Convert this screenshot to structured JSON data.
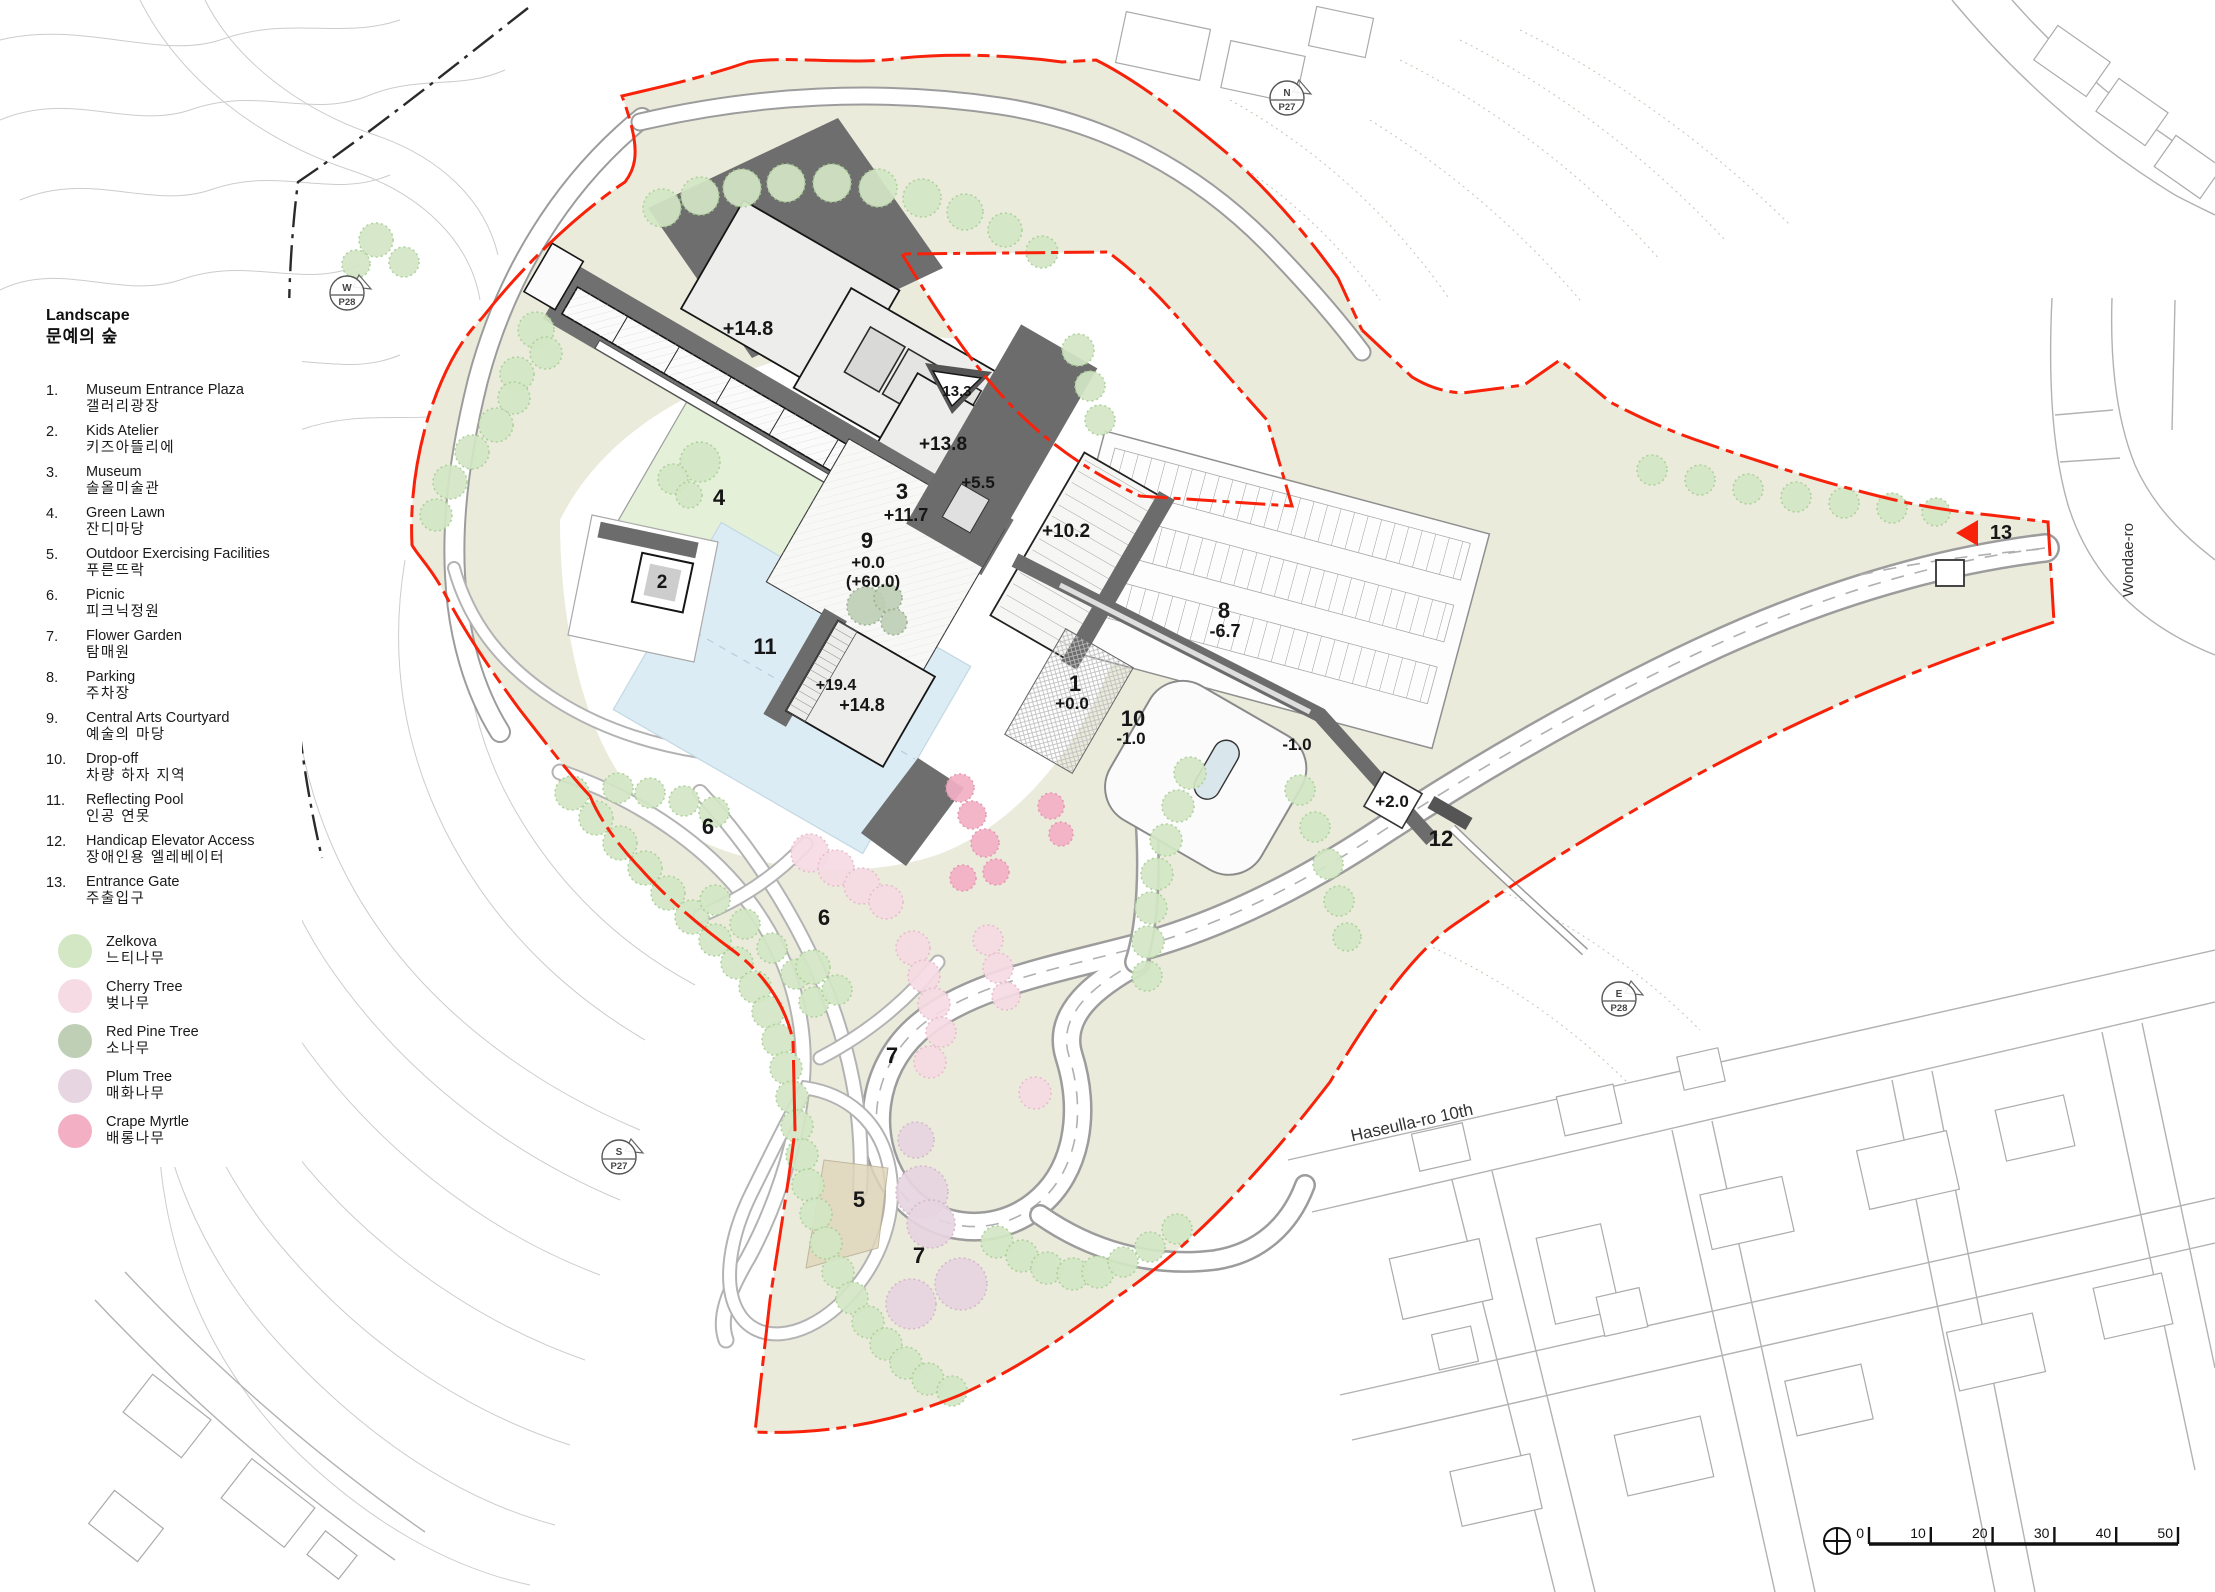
{
  "legend": {
    "title": "Landscape",
    "subtitle": "문예의 숲",
    "items": [
      {
        "num": "1.",
        "en": "Museum Entrance Plaza",
        "ko": "갤러리광장"
      },
      {
        "num": "2.",
        "en": "Kids Atelier",
        "ko": "키즈아뜰리에"
      },
      {
        "num": "3.",
        "en": "Museum",
        "ko": "솔올미술관"
      },
      {
        "num": "4.",
        "en": "Green Lawn",
        "ko": "잔디마당"
      },
      {
        "num": "5.",
        "en": "Outdoor Exercising Facilities",
        "ko": "푸른뜨락"
      },
      {
        "num": "6.",
        "en": "Picnic",
        "ko": "피크닉정원"
      },
      {
        "num": "7.",
        "en": "Flower Garden",
        "ko": "탐매원"
      },
      {
        "num": "8.",
        "en": "Parking",
        "ko": "주차장"
      },
      {
        "num": "9.",
        "en": "Central Arts Courtyard",
        "ko": "예술의 마당"
      },
      {
        "num": "10.",
        "en": "Drop-off",
        "ko": "차량 하자 지역"
      },
      {
        "num": "11.",
        "en": "Reflecting Pool",
        "ko": "인공 연못"
      },
      {
        "num": "12.",
        "en": "Handicap Elevator Access",
        "ko": "장애인용 엘레베이터"
      },
      {
        "num": "13.",
        "en": "Entrance Gate",
        "ko": "주출입구"
      }
    ],
    "trees": [
      {
        "en": "Zelkova",
        "ko": "느티나무",
        "color": "#d3e7c5"
      },
      {
        "en": "Cherry Tree",
        "ko": "벚나무",
        "color": "#f6dbe4"
      },
      {
        "en": "Red Pine Tree",
        "ko": "소나무",
        "color": "#becfb6"
      },
      {
        "en": "Plum Tree",
        "ko": "매화나무",
        "color": "#e7d5e1"
      },
      {
        "en": "Crape Myrtle",
        "ko": "배롱나무",
        "color": "#f3b0c5"
      }
    ]
  },
  "plan": {
    "boundary_color": "#f8220a",
    "labels": [
      {
        "text": "+14.8",
        "x": 748,
        "y": 335,
        "fs": 20
      },
      {
        "text": "13.3",
        "x": 957,
        "y": 396,
        "fs": 15
      },
      {
        "text": "+13.8",
        "x": 943,
        "y": 450,
        "fs": 19
      },
      {
        "text": "+5.5",
        "x": 978,
        "y": 488,
        "fs": 17
      },
      {
        "text": "3",
        "x": 902,
        "y": 499,
        "fs": 22
      },
      {
        "text": "+11.7",
        "x": 906,
        "y": 521,
        "fs": 18
      },
      {
        "text": "9",
        "x": 867,
        "y": 548,
        "fs": 22
      },
      {
        "text": "+0.0",
        "x": 868,
        "y": 568,
        "fs": 17
      },
      {
        "text": "(+60.0)",
        "x": 873,
        "y": 587,
        "fs": 17
      },
      {
        "text": "+10.2",
        "x": 1066,
        "y": 537,
        "fs": 19
      },
      {
        "text": "4",
        "x": 719,
        "y": 505,
        "fs": 22
      },
      {
        "text": "2",
        "x": 662,
        "y": 588,
        "fs": 19
      },
      {
        "text": "11",
        "x": 765,
        "y": 654,
        "fs": 22
      },
      {
        "text": "+19.4",
        "x": 836,
        "y": 690,
        "fs": 16
      },
      {
        "text": "+14.8",
        "x": 862,
        "y": 711,
        "fs": 18
      },
      {
        "text": "8",
        "x": 1224,
        "y": 618,
        "fs": 22
      },
      {
        "text": "-6.7",
        "x": 1225,
        "y": 637,
        "fs": 18
      },
      {
        "text": "1",
        "x": 1075,
        "y": 691,
        "fs": 22
      },
      {
        "text": "+0.0",
        "x": 1072,
        "y": 709,
        "fs": 17
      },
      {
        "text": "10",
        "x": 1133,
        "y": 726,
        "fs": 22
      },
      {
        "text": "-1.0",
        "x": 1131,
        "y": 744,
        "fs": 17
      },
      {
        "text": "-1.0",
        "x": 1297,
        "y": 750,
        "fs": 17
      },
      {
        "text": "+2.0",
        "x": 1392,
        "y": 807,
        "fs": 17
      },
      {
        "text": "12",
        "x": 1441,
        "y": 846,
        "fs": 22
      },
      {
        "text": "6",
        "x": 708,
        "y": 834,
        "fs": 22
      },
      {
        "text": "6",
        "x": 824,
        "y": 925,
        "fs": 22
      },
      {
        "text": "7",
        "x": 892,
        "y": 1063,
        "fs": 22
      },
      {
        "text": "5",
        "x": 859,
        "y": 1207,
        "fs": 22
      },
      {
        "text": "7",
        "x": 919,
        "y": 1263,
        "fs": 22
      },
      {
        "text": "13",
        "x": 2001,
        "y": 539,
        "fs": 20
      }
    ],
    "roads": [
      {
        "name": "Wondae-ro",
        "x": 2133,
        "y": 560,
        "rot": -90,
        "fs": 15
      },
      {
        "name": "Haseulla-ro 10th",
        "x": 1413,
        "y": 1128,
        "rot": -12.5,
        "fs": 17
      }
    ],
    "compass": [
      {
        "dir": "N",
        "page": "P27",
        "x": 1287,
        "y": 98
      },
      {
        "dir": "W",
        "page": "P28",
        "x": 347,
        "y": 293
      },
      {
        "dir": "E",
        "page": "P28",
        "x": 1619,
        "y": 999
      },
      {
        "dir": "S",
        "page": "P27",
        "x": 619,
        "y": 1157
      }
    ],
    "scalebar": {
      "ticks": [
        "0",
        "10",
        "20",
        "30",
        "40",
        "50"
      ]
    }
  }
}
